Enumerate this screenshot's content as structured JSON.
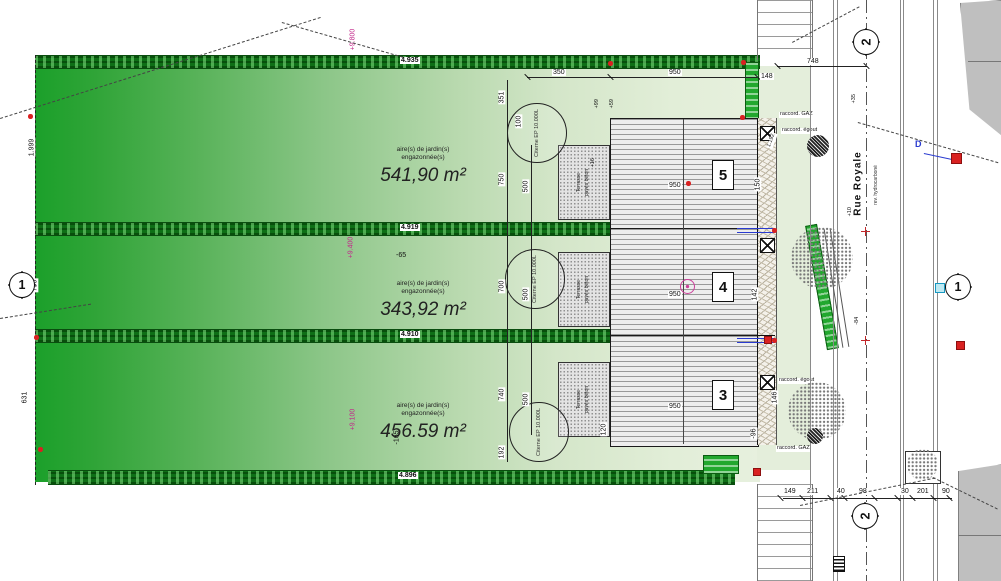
{
  "street": {
    "name": "Rue Royale",
    "note": "rev. hydrocarboné"
  },
  "markers": {
    "section_top": "2",
    "section_bottom": "2",
    "section_left": "1",
    "section_right": "1",
    "d": "D"
  },
  "hedges": {
    "h1": "4.935",
    "h2": "4.919",
    "h3": "4.910",
    "h4": "4.896"
  },
  "parcels": [
    {
      "caption1": "aire(s) de jardin(s)",
      "caption2": "engazonnée(s)",
      "area": "541,90 m²"
    },
    {
      "caption1": "aire(s) de jardin(s)",
      "caption2": "engazonnée(s)",
      "area": "343,92 m²"
    },
    {
      "caption1": "aire(s) de jardin(s)",
      "caption2": "engazonnée(s)",
      "area": "456.59 m²"
    }
  ],
  "units": [
    "5",
    "4",
    "3"
  ],
  "terrace": {
    "line1": "Terrasse",
    "line2": "pavés béton"
  },
  "cistern": {
    "label": "Citerne EP 10.000L"
  },
  "utilities": {
    "gaz": "raccord. GAZ",
    "egout": "raccord. égout"
  },
  "elevations": {
    "e1": "+9.800",
    "e2": "+9.400",
    "e3": "+9.100",
    "m1": "-65",
    "m2": "-165"
  },
  "dims": {
    "top_a": "350",
    "top_b": "950",
    "front": "148",
    "street_width": "748",
    "unit5": "950",
    "unit4": "950",
    "unit3": "950",
    "a351": "351",
    "a750": "750",
    "a700": "700",
    "a740": "740",
    "a192": "192",
    "b500a": "500",
    "b500b": "500",
    "b500c": "500",
    "b100": "100",
    "b120": "120",
    "f1192": "1.192",
    "f150": "150",
    "f142": "142",
    "f146": "146",
    "f96": "-96",
    "f16": "+16",
    "f99": "+99",
    "f59": "+59",
    "s35": "+35",
    "s10": "+10",
    "s84": "-84",
    "bottom": [
      "149",
      "211",
      "40",
      "98",
      "30",
      "201",
      "90"
    ],
    "boundary": {
      "b1": "1.999",
      "b2": "631",
      "b3": "790"
    }
  },
  "colors": {
    "site_green": "#23a12c",
    "hedge_green": "#0d6b15",
    "accent_pink": "#c2278a",
    "accent_blue": "#2a3bd0",
    "accent_red": "#d92121"
  }
}
